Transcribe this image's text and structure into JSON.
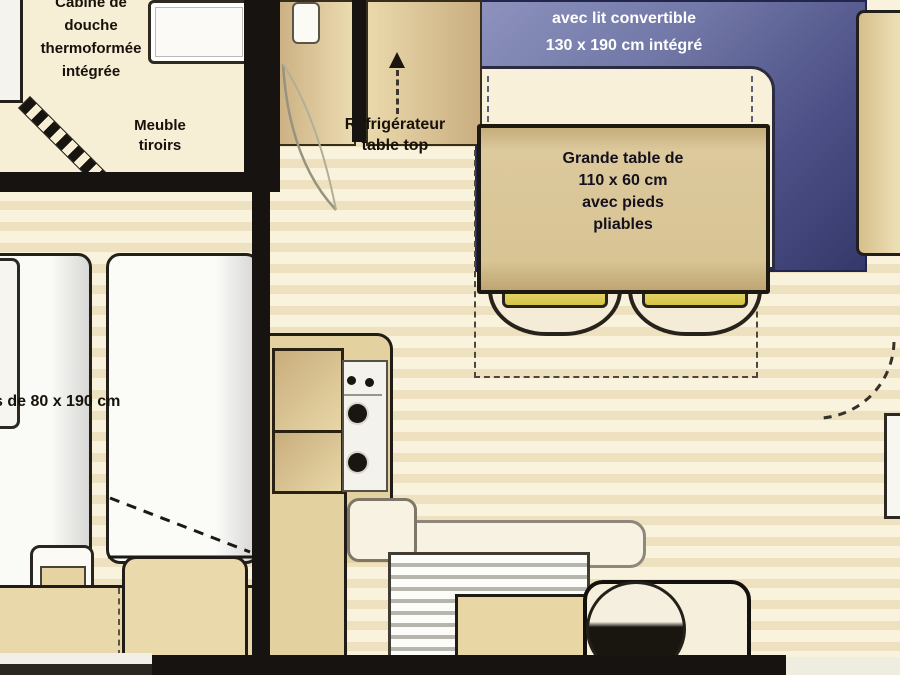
{
  "plan_title": "mobile-home floor plan (cropped view)",
  "labels": {
    "bathroom": {
      "line1": "Cabine de",
      "line2": "douche",
      "line3": "thermoformée",
      "line4": "intégrée"
    },
    "drawer_unit": {
      "line1": "Meuble",
      "line2": "tiroirs"
    },
    "fridge": {
      "line1": "Réfrigérateur",
      "line2": "table top"
    },
    "sofa": {
      "line1": "avec lit convertible",
      "line2": "130 x 190 cm intégré"
    },
    "table": {
      "line1": "Grande table de",
      "line2": "110 x 60 cm",
      "line3": "avec pieds",
      "line4": "pliables"
    },
    "beds": {
      "partial": "s de 80 x 190 cm"
    }
  },
  "colors": {
    "floor_cream": "#f9f2dc",
    "floor_stripe": "#eee1c0",
    "wall_black": "#171310",
    "sofa_navy": "#43477c",
    "sofa_light": "#8a90ba",
    "wood_tan": "#d7c394",
    "chair_yellow": "#e3d153",
    "label_white": "#ffffff"
  }
}
